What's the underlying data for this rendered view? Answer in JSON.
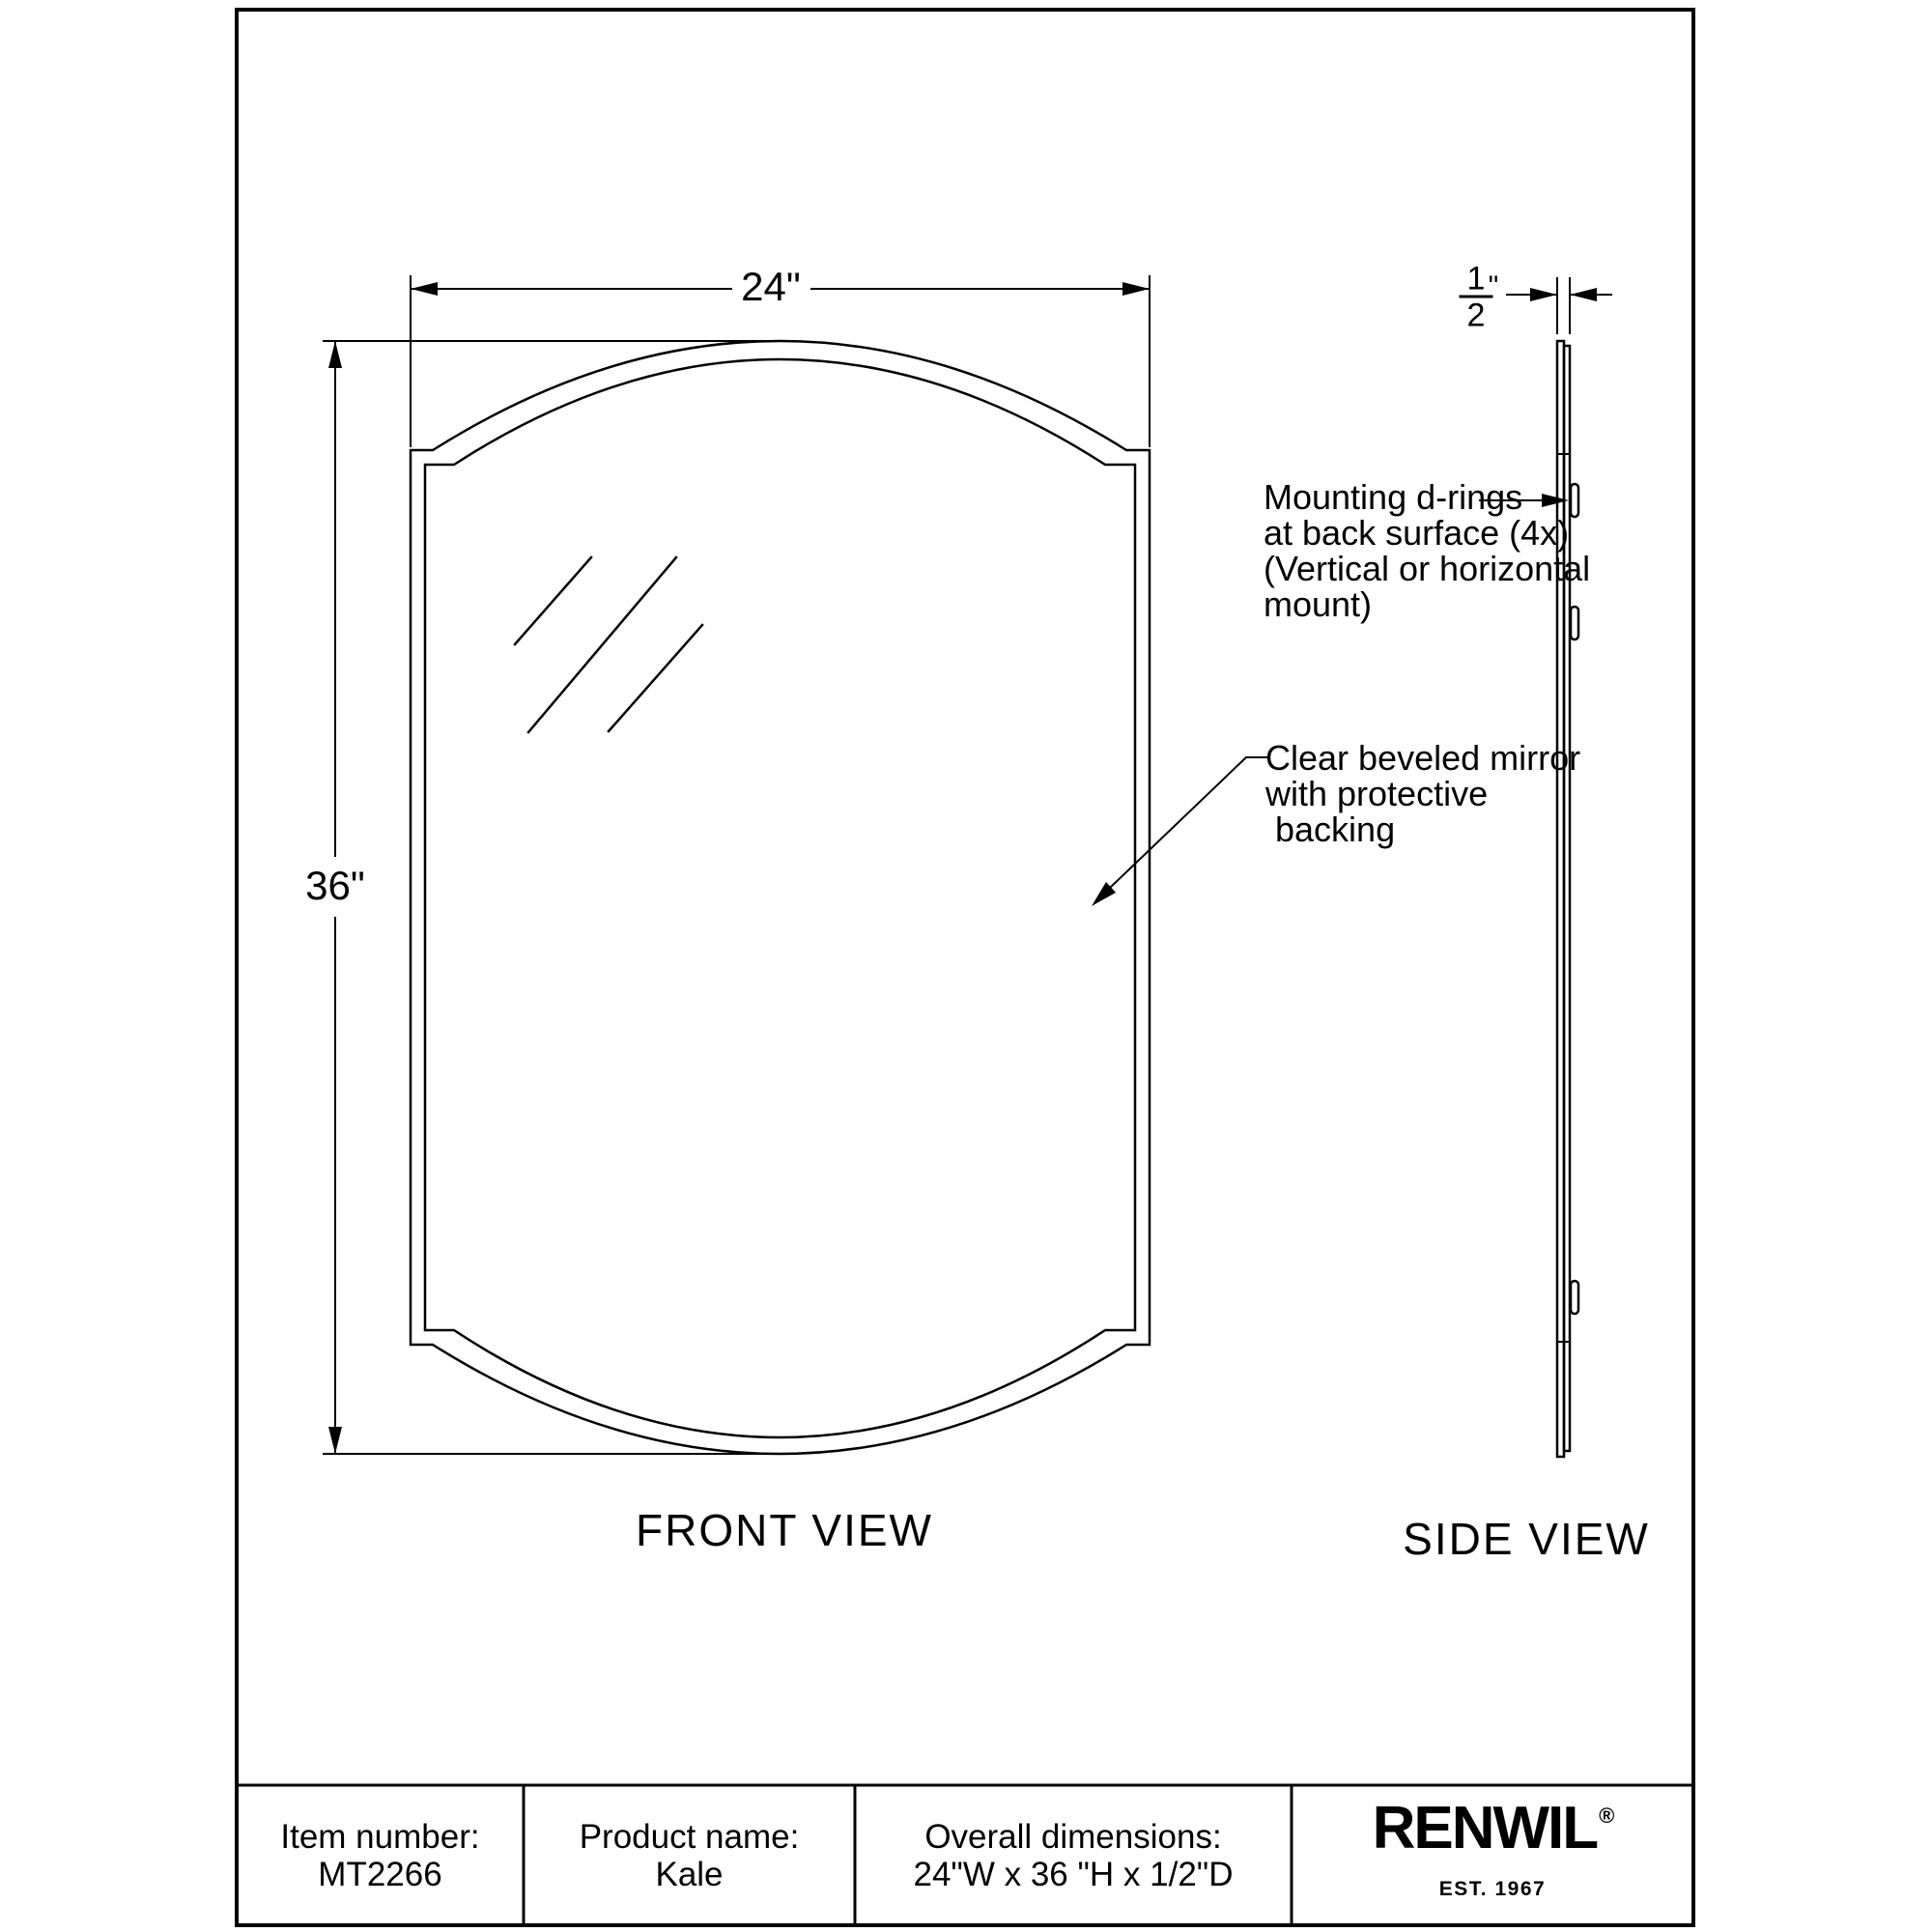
{
  "sheet": {
    "front_view": {
      "label": "FRONT VIEW",
      "width": "24\"",
      "height": "36\""
    },
    "side_view": {
      "label": "SIDE VIEW",
      "depth_numerator": "1",
      "depth_denominator": "2",
      "depth_unit_mark": "\""
    },
    "annotations": {
      "mounting_rings": {
        "lines": [
          "Mounting d-rings",
          "at back surface (4x)",
          "(Vertical or horizontal",
          "mount)"
        ]
      },
      "mirror": {
        "lines": [
          "Clear beveled mirror",
          "with protective",
          " backing"
        ]
      }
    },
    "title_block": {
      "item_label": "Item number:",
      "item_value": "MT2266",
      "product_label": "Product name:",
      "product_value": "Kale",
      "dimensions_label": "Overall dimensions:",
      "dimensions_value": "24\"W x 36 \"H x 1/2\"D",
      "brand_name": "RENWIL",
      "brand_registered": "®",
      "brand_established": "EST. 1967"
    }
  }
}
